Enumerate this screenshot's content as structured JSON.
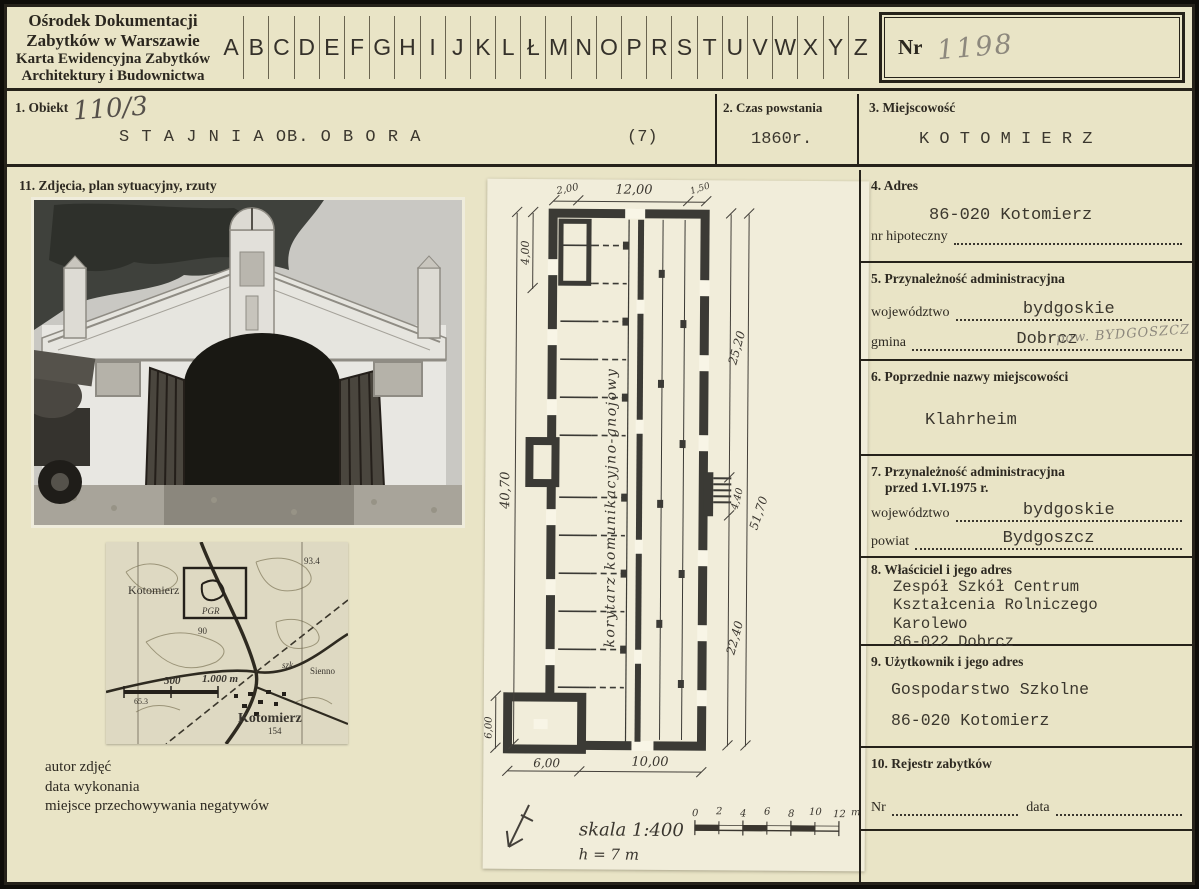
{
  "colors": {
    "card_bg": "#e9e4c6",
    "ink": "#2d2921",
    "typed_ink": "#3b372e",
    "pencil": "#8d887d",
    "plan_paper": "#f1edda"
  },
  "header": {
    "institution_lines": [
      "Ośrodek Dokumentacji",
      "Zabytków w Warszawie",
      "Karta Ewidencyjna Zabytków",
      "Architektury i Budownictwa"
    ],
    "alphabet": [
      "A",
      "B",
      "C",
      "D",
      "E",
      "F",
      "G",
      "H",
      "I",
      "J",
      "K",
      "L",
      "Ł",
      "M",
      "N",
      "O",
      "P",
      "R",
      "S",
      "T",
      "U",
      "V",
      "W",
      "X",
      "Y",
      "Z"
    ],
    "nr_label": "Nr",
    "nr_value": "1198"
  },
  "fields": {
    "obiekt": {
      "label": "1. Obiekt",
      "handwritten": "110/3",
      "value": "S T A J N I A   OB. O B O R A",
      "suffix": "(7)"
    },
    "czas": {
      "label": "2. Czas powstania",
      "value": "1860r."
    },
    "miejscowosc": {
      "label": "3. Miejscowość",
      "value": "K O T O M I E R Z"
    },
    "adres": {
      "label": "4. Adres",
      "value": "86-020 Kotomierz",
      "hipoteczny_label": "nr hipoteczny"
    },
    "przynaleznosc": {
      "label": "5. Przynależność administracyjna",
      "wojewodztwo_label": "województwo",
      "wojewodztwo": "bydgoskie",
      "gmina_label": "gmina",
      "gmina": "Dobrcz",
      "pencil_note": "pow. BYDGOSZCZ"
    },
    "poprzednie": {
      "label": "6. Poprzednie nazwy miejscowości",
      "value": "Klahrheim"
    },
    "przyn_przed": {
      "label_line1": "7. Przynależność administracyjna",
      "label_line2": "przed 1.VI.1975 r.",
      "wojewodztwo_label": "województwo",
      "wojewodztwo": "bydgoskie",
      "powiat_label": "powiat",
      "powiat": "Bydgoszcz"
    },
    "wlasciciel": {
      "label": "8. Właściciel i jego adres",
      "lines": [
        "Zespół Szkół Centrum",
        "Kształcenia Rolniczego",
        "Karolewo",
        "86-022 Dobrcz"
      ]
    },
    "uzytkownik": {
      "label": "9. Użytkownik i jego adres",
      "lines": [
        "Gospodarstwo Szkolne",
        "86-020 Kotomierz"
      ]
    },
    "rejestr": {
      "label": "10. Rejestr zabytków",
      "nr_label": "Nr",
      "data_label": "data"
    },
    "zdjecia": {
      "label": "11. Zdjęcia, plan sytuacyjny, rzuty"
    }
  },
  "captions": [
    "autor zdjęć",
    "data wykonania",
    "miejsce przechowywania negatywów"
  ],
  "map": {
    "town_top": "Kotomierz",
    "spot_height": "93.4",
    "contour_90": "90",
    "site_label": "PGR",
    "school": "szk.",
    "sienno": "Sienno",
    "town_bottom": "Kotomierz",
    "elev_154": "154",
    "scale_500": "500",
    "scale_1000": "1.000 m",
    "bench_653": "65.3"
  },
  "plan": {
    "corridor_label": "korytarz komunikacyjno-gnojowy",
    "dims": {
      "top_left": "2,00",
      "top_center": "12,00",
      "top_right": "1,50",
      "left_top": "4,00",
      "left_mid": "40,70",
      "left_bottom": "6,00",
      "right_upper": "25,20",
      "right_mid": "4,40",
      "right_total": "51,70",
      "right_lower": "22,40",
      "bottom_left": "6,00",
      "bottom_right": "10,00"
    },
    "scale_text": "skala 1:400",
    "height_text": "h = 7 m",
    "scalebar_ticks": [
      "0",
      "2",
      "4",
      "6",
      "8",
      "10",
      "12"
    ],
    "scalebar_unit": "m"
  }
}
